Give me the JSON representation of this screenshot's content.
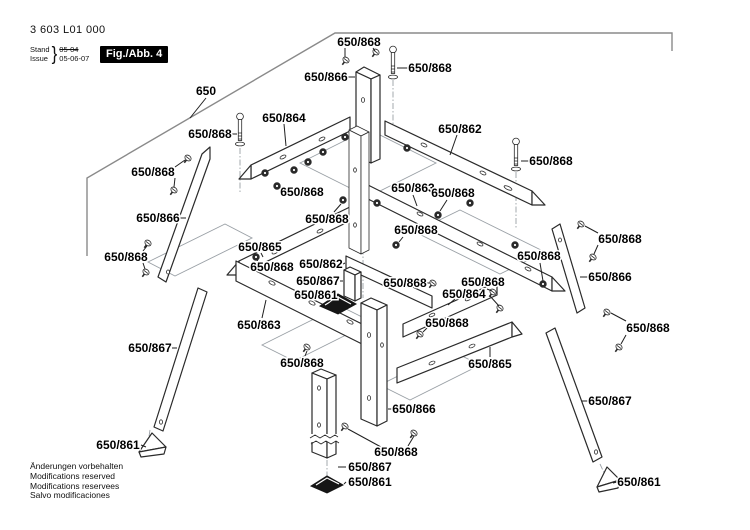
{
  "meta": {
    "part_number": "3 603 L01 000",
    "stand_label": "Stand",
    "issue_label": "Issue",
    "brace": "}",
    "old_date": "05-04",
    "new_date": "05-06-07",
    "fig_label": "Fig./Abb. 4"
  },
  "footer": {
    "lines": [
      "Änderungen vorbehalten",
      "Modifications reserved",
      "Modifications reservees",
      "Salvo modificaciones"
    ]
  },
  "colors": {
    "diagram_line": "#2a2a2a",
    "phantom_line": "#9aa0a6",
    "label_color": "#000000",
    "fig_box_bg": "#000000",
    "fig_box_text": "#ffffff",
    "foot_fill": "#161616",
    "table_line": "#8a8a8a"
  },
  "diagram": {
    "labels": [
      {
        "text": "650",
        "x": 206,
        "y": 91,
        "leaders": [
          "206,98 190,118"
        ]
      },
      {
        "text": "650/868",
        "x": 359,
        "y": 42,
        "leaders": [
          "345,48 345,57",
          "373,48 375,51"
        ]
      },
      {
        "text": "650/868",
        "x": 430,
        "y": 68,
        "leaders": [
          "408,68 397,68"
        ]
      },
      {
        "text": "650/866",
        "x": 326,
        "y": 77,
        "leaders": [
          "348,77 355,77"
        ]
      },
      {
        "text": "650/864",
        "x": 284,
        "y": 118,
        "leaders": [
          "284,124 286,146"
        ]
      },
      {
        "text": "650/862",
        "x": 460,
        "y": 129,
        "leaders": [
          "457,135 450,155"
        ]
      },
      {
        "text": "650/868",
        "x": 210,
        "y": 134,
        "leaders": [
          "232,134 237,134"
        ]
      },
      {
        "text": "650/868",
        "x": 153,
        "y": 172,
        "leaders": [
          "175,167 185,160",
          "175,178 174,187"
        ]
      },
      {
        "text": "650/868",
        "x": 551,
        "y": 161,
        "leaders": [
          "529,161 521,161"
        ]
      },
      {
        "text": "650/863",
        "x": 413,
        "y": 188,
        "leaders": [
          "413,195 417,206"
        ]
      },
      {
        "text": "650/868",
        "x": 453,
        "y": 193,
        "leaders": [
          "447,200 440,211"
        ]
      },
      {
        "text": "650/866",
        "x": 158,
        "y": 218,
        "leaders": [
          "180,218 186,218"
        ]
      },
      {
        "text": "650/868",
        "x": 302,
        "y": 192,
        "leaders": [
          "283,189 279,187"
        ]
      },
      {
        "text": "650/868",
        "x": 327,
        "y": 219,
        "leaders": [
          "334,212 341,204"
        ]
      },
      {
        "text": "650/868",
        "x": 620,
        "y": 239,
        "leaders": [
          "598,233 585,226",
          "598,245 594,254"
        ]
      },
      {
        "text": "650/865",
        "x": 260,
        "y": 247,
        "leaders": [
          "261,253 263,257"
        ]
      },
      {
        "text": "650/868",
        "x": 126,
        "y": 257,
        "leaders": [
          "143,251 147,246",
          "143,263 145,269"
        ]
      },
      {
        "text": "650/868",
        "x": 272,
        "y": 267,
        "leaders": [
          "259,263 257,260"
        ]
      },
      {
        "text": "650/862",
        "x": 321,
        "y": 264,
        "leaders": [
          "343,264 345,263"
        ]
      },
      {
        "text": "650/867",
        "x": 318,
        "y": 281,
        "leaders": [
          "340,281 343,281"
        ]
      },
      {
        "text": "650/861",
        "x": 316,
        "y": 295,
        "leaders": [
          "339,296 330,303"
        ]
      },
      {
        "text": "650/868",
        "x": 539,
        "y": 256,
        "leaders": [
          "540,263 543,281"
        ]
      },
      {
        "text": "650/866",
        "x": 610,
        "y": 277,
        "leaders": [
          "588,277 580,277"
        ]
      },
      {
        "text": "650/864",
        "x": 464,
        "y": 294,
        "leaders": [
          "455,299 448,305"
        ]
      },
      {
        "text": "650/868",
        "x": 483,
        "y": 282,
        "leaders": [
          "487,289 492,291",
          "490,296 499,306"
        ]
      },
      {
        "text": "650/868",
        "x": 405,
        "y": 283,
        "leaders": [
          "427,283 430,283"
        ]
      },
      {
        "text": "650/863",
        "x": 259,
        "y": 325,
        "leaders": [
          "262,318 266,300"
        ]
      },
      {
        "text": "650/868",
        "x": 648,
        "y": 328,
        "leaders": [
          "626,321 611,313",
          "626,335 621,344"
        ]
      },
      {
        "text": "650/868",
        "x": 416,
        "y": 230,
        "leaders": [
          "403,237 399,242"
        ]
      },
      {
        "text": "650/865",
        "x": 490,
        "y": 364,
        "leaders": [
          "490,357 490,347"
        ]
      },
      {
        "text": "650/868",
        "x": 302,
        "y": 363,
        "leaders": [
          "305,356 307,351"
        ]
      },
      {
        "text": "650/868",
        "x": 447,
        "y": 323,
        "leaders": [
          "428,327 423,332"
        ]
      },
      {
        "text": "650/866",
        "x": 414,
        "y": 409,
        "leaders": [
          "392,409 388,409"
        ]
      },
      {
        "text": "650/867",
        "x": 610,
        "y": 401,
        "leaders": [
          "588,401 582,401"
        ]
      },
      {
        "text": "650/868",
        "x": 396,
        "y": 452,
        "leaders": [
          "381,447 348,429",
          "408,446 414,436"
        ]
      },
      {
        "text": "650/867",
        "x": 370,
        "y": 467,
        "leaders": [
          "346,467 338,467"
        ]
      },
      {
        "text": "650/861",
        "x": 370,
        "y": 482,
        "leaders": [
          "346,482 344,484"
        ]
      },
      {
        "text": "650/861",
        "x": 118,
        "y": 445,
        "leaders": [
          "141,445 146,447"
        ]
      },
      {
        "text": "650/861",
        "x": 639,
        "y": 482,
        "leaders": [
          "617,482 613,483"
        ]
      },
      {
        "text": "650/867",
        "x": 150,
        "y": 348,
        "leaders": [
          "172,348 177,348"
        ]
      }
    ],
    "hardware": [
      {
        "type": "bolt",
        "x": 240,
        "y": 114
      },
      {
        "type": "bolt",
        "x": 393,
        "y": 47
      },
      {
        "type": "bolt",
        "x": 516,
        "y": 139
      },
      {
        "type": "screw",
        "x": 346,
        "y": 60
      },
      {
        "type": "screw",
        "x": 376,
        "y": 52
      },
      {
        "type": "screw",
        "x": 188,
        "y": 158
      },
      {
        "type": "screw",
        "x": 174,
        "y": 190
      },
      {
        "type": "screw",
        "x": 148,
        "y": 243
      },
      {
        "type": "screw",
        "x": 146,
        "y": 272
      },
      {
        "type": "screw",
        "x": 581,
        "y": 224
      },
      {
        "type": "screw",
        "x": 593,
        "y": 257
      },
      {
        "type": "screw",
        "x": 607,
        "y": 312
      },
      {
        "type": "screw",
        "x": 619,
        "y": 347
      },
      {
        "type": "screw",
        "x": 433,
        "y": 283
      },
      {
        "type": "screw",
        "x": 493,
        "y": 292
      },
      {
        "type": "screw",
        "x": 500,
        "y": 308
      },
      {
        "type": "screw",
        "x": 307,
        "y": 347
      },
      {
        "type": "screw",
        "x": 345,
        "y": 426
      },
      {
        "type": "screw",
        "x": 414,
        "y": 433
      },
      {
        "type": "screw",
        "x": 420,
        "y": 334
      },
      {
        "type": "nut",
        "x": 345,
        "y": 137
      },
      {
        "type": "nut",
        "x": 323,
        "y": 152
      },
      {
        "type": "nut",
        "x": 308,
        "y": 162
      },
      {
        "type": "nut",
        "x": 294,
        "y": 170
      },
      {
        "type": "nut",
        "x": 265,
        "y": 173
      },
      {
        "type": "nut",
        "x": 277,
        "y": 186
      },
      {
        "type": "nut",
        "x": 343,
        "y": 200
      },
      {
        "type": "nut",
        "x": 377,
        "y": 203
      },
      {
        "type": "nut",
        "x": 407,
        "y": 148
      },
      {
        "type": "nut",
        "x": 470,
        "y": 203
      },
      {
        "type": "nut",
        "x": 438,
        "y": 215
      },
      {
        "type": "nut",
        "x": 396,
        "y": 245
      },
      {
        "type": "nut",
        "x": 515,
        "y": 245
      },
      {
        "type": "nut",
        "x": 543,
        "y": 284
      },
      {
        "type": "nut",
        "x": 256,
        "y": 257
      }
    ]
  }
}
